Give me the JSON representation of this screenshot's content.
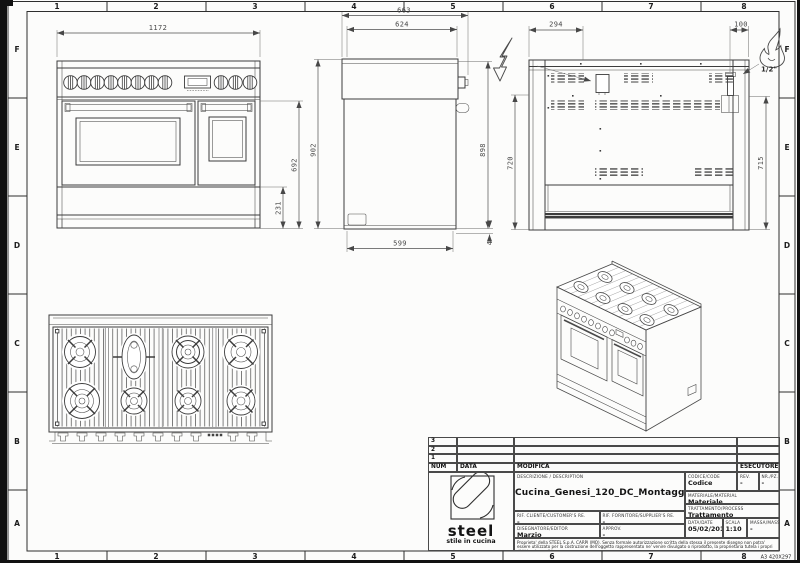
{
  "frame": {
    "cols": [
      "1",
      "2",
      "3",
      "4",
      "5",
      "6",
      "7",
      "8"
    ],
    "rows": [
      "F",
      "E",
      "D",
      "C",
      "B",
      "A"
    ],
    "sheet_format": "A3 420X297"
  },
  "dims": {
    "front_width": "1172",
    "front_door_h": "692",
    "front_base_h": "231",
    "side_depth": "663",
    "side_top_depth": "624",
    "side_height": "902",
    "side_back_height": "898",
    "side_base_depth": "599",
    "side_foot_gap": "4",
    "back_junction_x": "294",
    "back_gas_x": "100",
    "back_left_h": "720",
    "back_right_h": "715",
    "gas_size": "1/2\""
  },
  "revision": {
    "rows": [
      "3",
      "2",
      "1"
    ],
    "num": "NUM",
    "data": "DATA",
    "modifica": "MODIFICA",
    "esecutore": "ESECUTORE"
  },
  "title_block": {
    "logo_name": "steel",
    "logo_tagline": "stile in cucina",
    "description_label": "DESCRIZIONE / DESCRIPTION",
    "description": "Cucina_Genesi_120_DC_Montaggio",
    "code_label": "CODICE/CODE",
    "code": "Codice",
    "rev_label": "REV.",
    "rev": "-",
    "nr_label": "NR./PZ.",
    "nr": "-",
    "material_label": "MATERIALE/MATERIAL",
    "material": "Materiale",
    "customer_label": "RIF. CLIENTE/CUSTOMER'S RE.",
    "customer": "-",
    "supplier_label": "RIF. FORNITORE/SUPPLIER'S RE.",
    "supplier": "-",
    "process_label": "TRATTAMENTO/PROCESS",
    "process": "Trattamento",
    "editor_label": "DISEGNATORE/EDITOR",
    "editor": "Marzio",
    "approv_label": "APPROV.",
    "approv": "-",
    "date_label": "DATA/DATE",
    "date": "05/02/2016",
    "scale_label": "SCALA",
    "scale": "1:10",
    "mass_label": "MASSA/MASS kg",
    "mass": "-",
    "legal": "Proprieta' della STEEL S.p.A. CARPI (MO). Senza formale autorizzazione scritta della stessa il presente disegno non potra' essere utilizzato per la costruzione dell'oggetto rappresentato ne' venire divulgato o riprodotto, la proprietaria tutela i propri diritti a rigore di legge."
  },
  "colors": {
    "line": "#3c3c3c",
    "paper": "#fcfcfb"
  }
}
